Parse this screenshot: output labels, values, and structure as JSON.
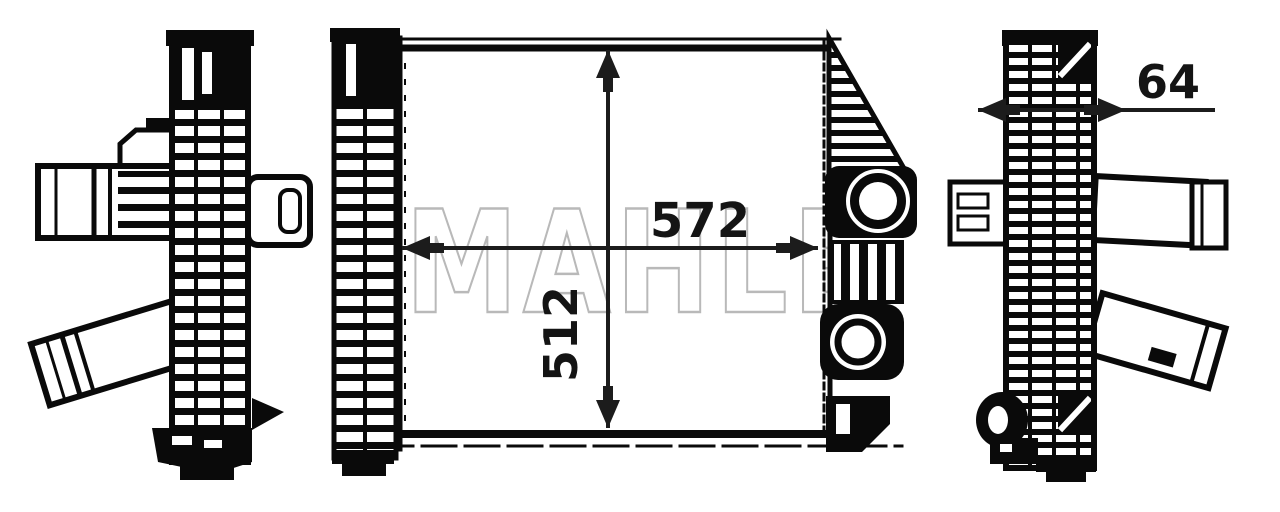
{
  "drawing": {
    "type": "technical-drawing",
    "watermark": "MAHLE",
    "dimensions": {
      "width": "572",
      "height": "512",
      "depth": "64"
    },
    "colors": {
      "line": "#0a0a0a",
      "dimension_text": "#141414",
      "watermark_stroke": "#b9b9b9",
      "background": "#ffffff"
    }
  }
}
